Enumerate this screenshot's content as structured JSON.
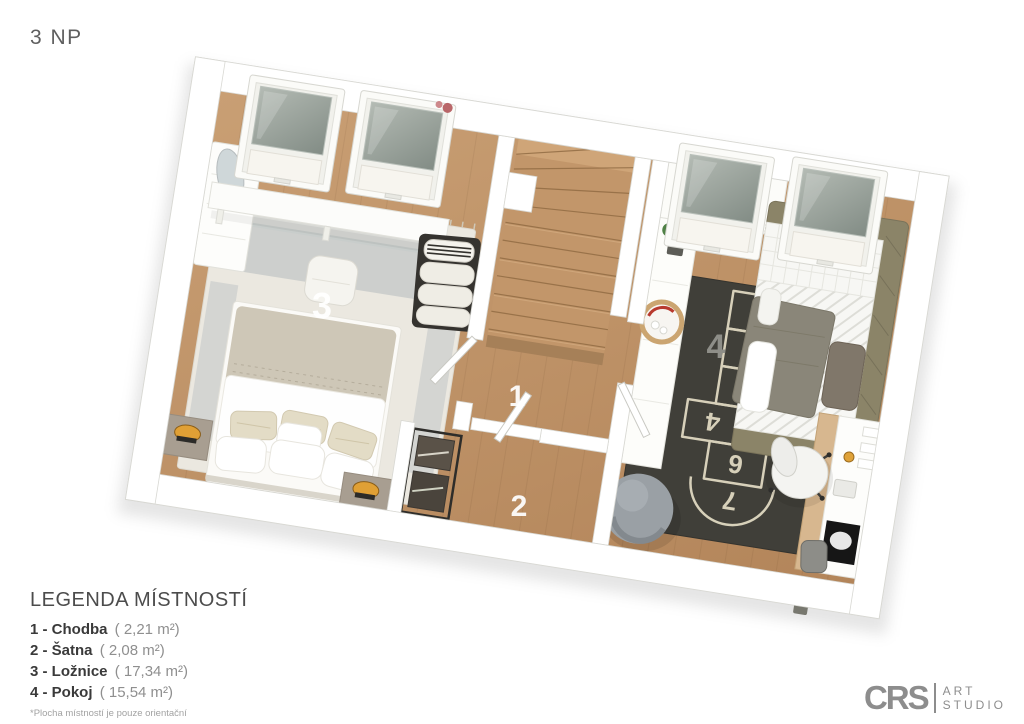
{
  "title": "3 NP",
  "plan": {
    "room_labels": {
      "hallway": "1",
      "wardrobe": "2",
      "bedroom": "3",
      "kids_room": "4"
    },
    "hopscotch_numbers": [
      "1",
      "2",
      "3",
      "4",
      "5",
      "6",
      "7"
    ],
    "colors": {
      "wood_floor": "#c1976b",
      "wall_white": "#ffffff",
      "bedroom_rug": "#ebe8e0",
      "kids_rug": "#403f39",
      "chalk": "#e4ddc5",
      "lamp_accent": "#e0a035",
      "plant_green": "#41703a",
      "kids_bed_frame": "#8b8468",
      "skylight_glass": "#9aa49e"
    }
  },
  "legend": {
    "title": "LEGENDA MÍSTNOSTÍ",
    "rooms": [
      {
        "label": "1 - Chodba",
        "area": "( 2,21 m²)"
      },
      {
        "label": "2 - Šatna",
        "area": "( 2,08 m²)"
      },
      {
        "label": "3 - Ložnice",
        "area": "( 17,34 m²)"
      },
      {
        "label": "4 - Pokoj",
        "area": "( 15,54 m²)"
      }
    ],
    "footnote": "*Plocha místností je pouze orientační"
  },
  "logo": {
    "brand": "CRS",
    "studio_line1": "ART",
    "studio_line2": "STUDIO"
  }
}
